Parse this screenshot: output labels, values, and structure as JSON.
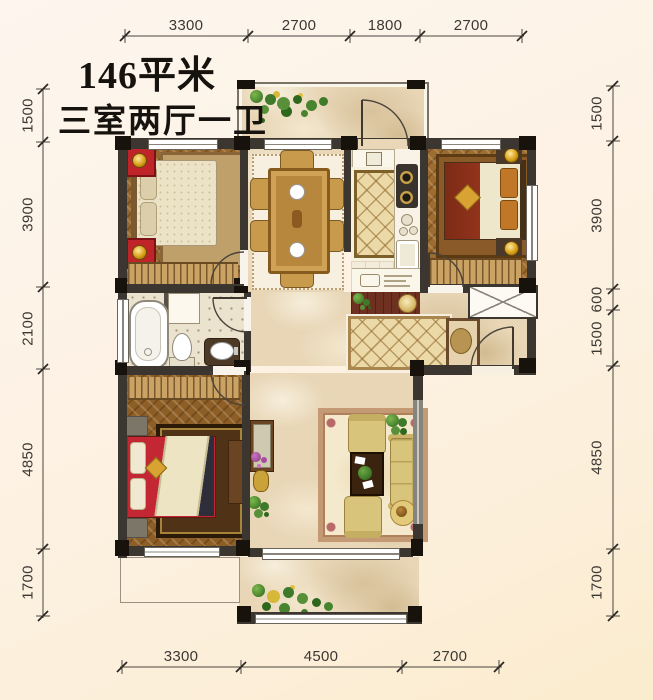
{
  "title": "146平米",
  "subtitle": "三室两厅一卫",
  "dimensions": {
    "top": [
      "3300",
      "2700",
      "1800",
      "2700"
    ],
    "bottom": [
      "3300",
      "4500",
      "2700"
    ],
    "left": [
      "1500",
      "3900",
      "2100",
      "4850",
      "1700"
    ],
    "right": [
      "1500",
      "3900",
      "600",
      "1500",
      "4850",
      "1700"
    ]
  },
  "colors": {
    "background": "#fdf3e7",
    "wall_dark": "#3b362f",
    "pillar_black": "#17120c",
    "wood_floor": "#96672e",
    "marble_floor": "#e8d6b6",
    "kitchen_floor": "#f4ecda",
    "accent_red": "#bf2428",
    "sofa_gold": "#d9c47c",
    "plant_green": "#3e7a2a",
    "dimension_text": "#3c3833"
  }
}
